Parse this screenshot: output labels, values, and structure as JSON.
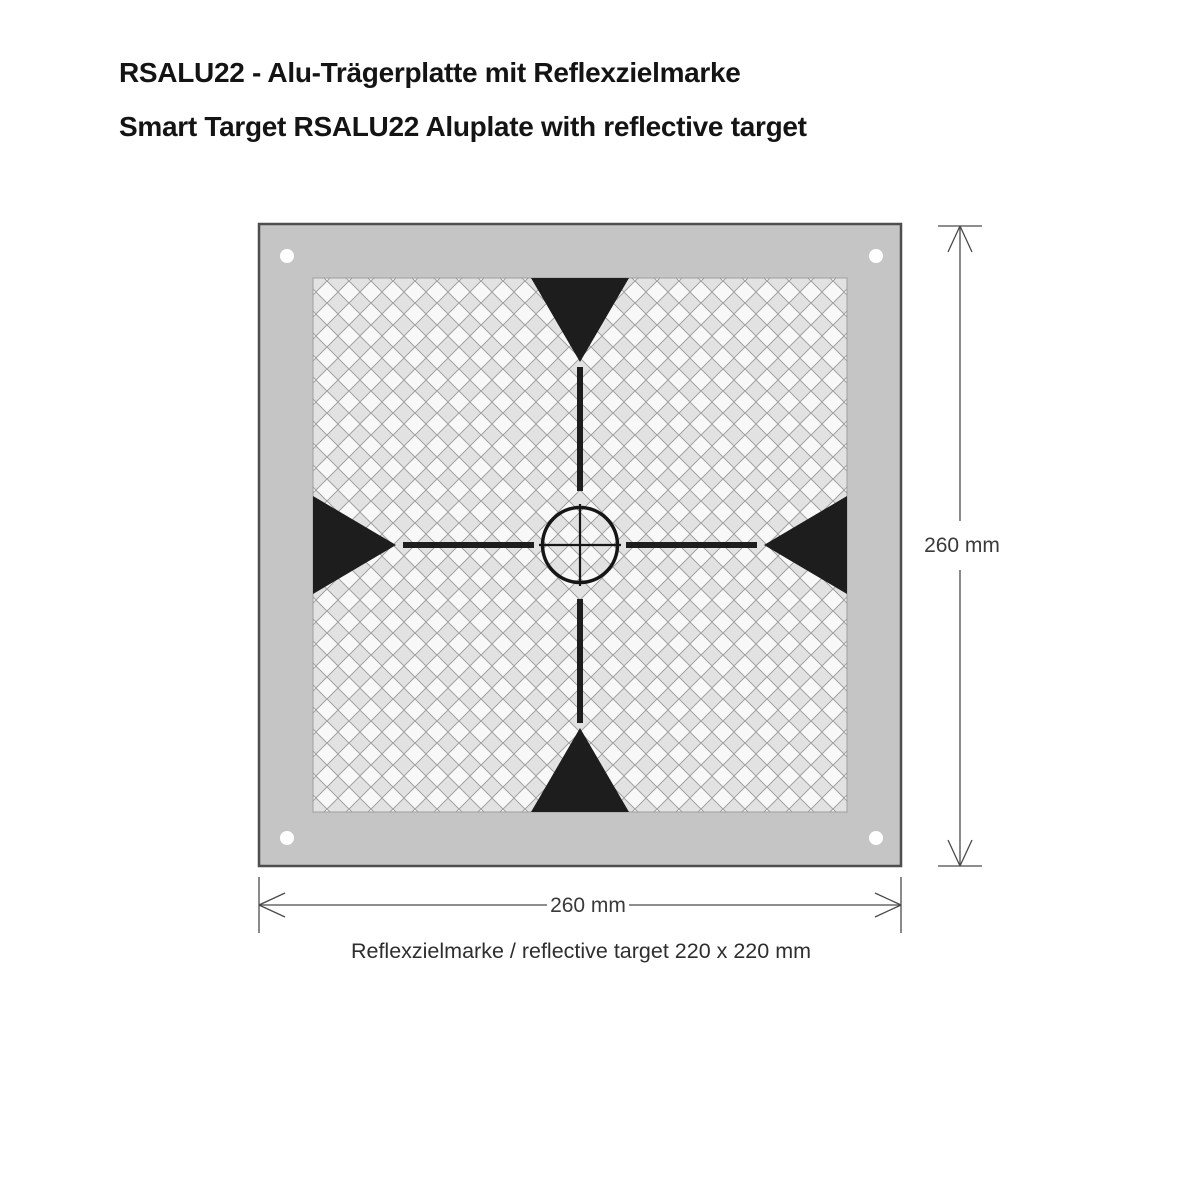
{
  "header": {
    "title_de": "RSALU22 - Alu-Trägerplatte mit Reflexzielmarke",
    "title_en": "Smart Target RSALU22 Aluplate with reflective target"
  },
  "diagram": {
    "dim_height_label": "260 mm",
    "dim_width_label": "260 mm",
    "caption": "Reflexzielmarke / reflective target 220 x 220 mm"
  },
  "colors": {
    "background": "#ffffff",
    "plate_gray": "#c5c5c5",
    "plate_outline": "#4e4e4e",
    "mounting_hole": "#ffffff",
    "pattern_light": "#f8f8f8",
    "pattern_gray": "#e2e2e2",
    "pattern_grid": "#9c9c9c",
    "marker_black": "#1d1d1d",
    "dimension_line": "#4a4a4a",
    "title_text": "#141414"
  }
}
